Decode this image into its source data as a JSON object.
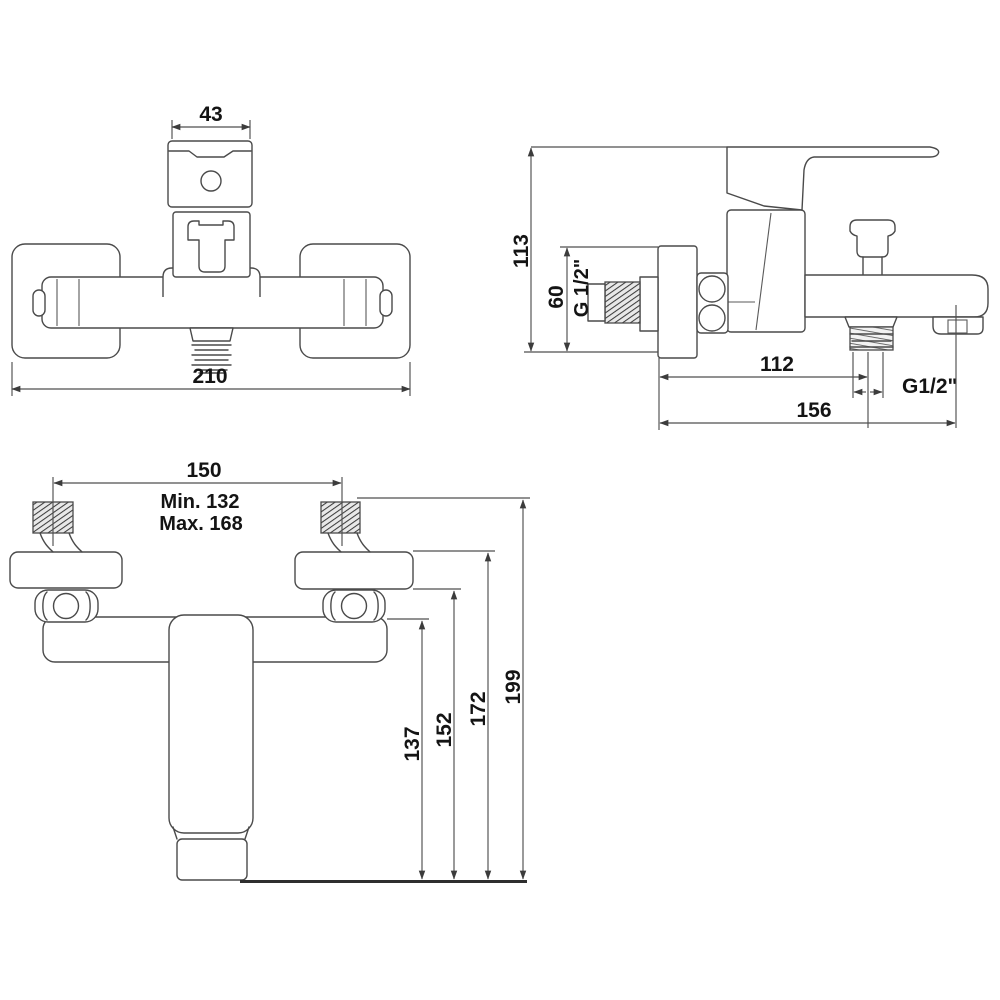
{
  "drawing_type": "bath-shower-mixer-technical-drawing",
  "colors": {
    "background": "#ffffff",
    "line": "#4a4a4a",
    "dimension_line": "#4f4f4f",
    "text": "#141414",
    "baseline": "#2e2e2e"
  },
  "front_view": {
    "handle_width": "43",
    "overall_width": "210"
  },
  "side_view": {
    "overall_depth": "113",
    "plate_height": "60",
    "inlet_thread": "G 1/2\"",
    "wall_to_outlet": "112",
    "outlet_thread": "G1/2\"",
    "wall_to_spout_end": "156"
  },
  "installation_view": {
    "inlet_centers": "150",
    "min_centers": "Min. 132",
    "max_centers": "Max. 168",
    "height_to_body": "137",
    "height_to_flange_bottom": "152",
    "height_to_flange_top": "172",
    "height_to_inlet_top": "199"
  }
}
